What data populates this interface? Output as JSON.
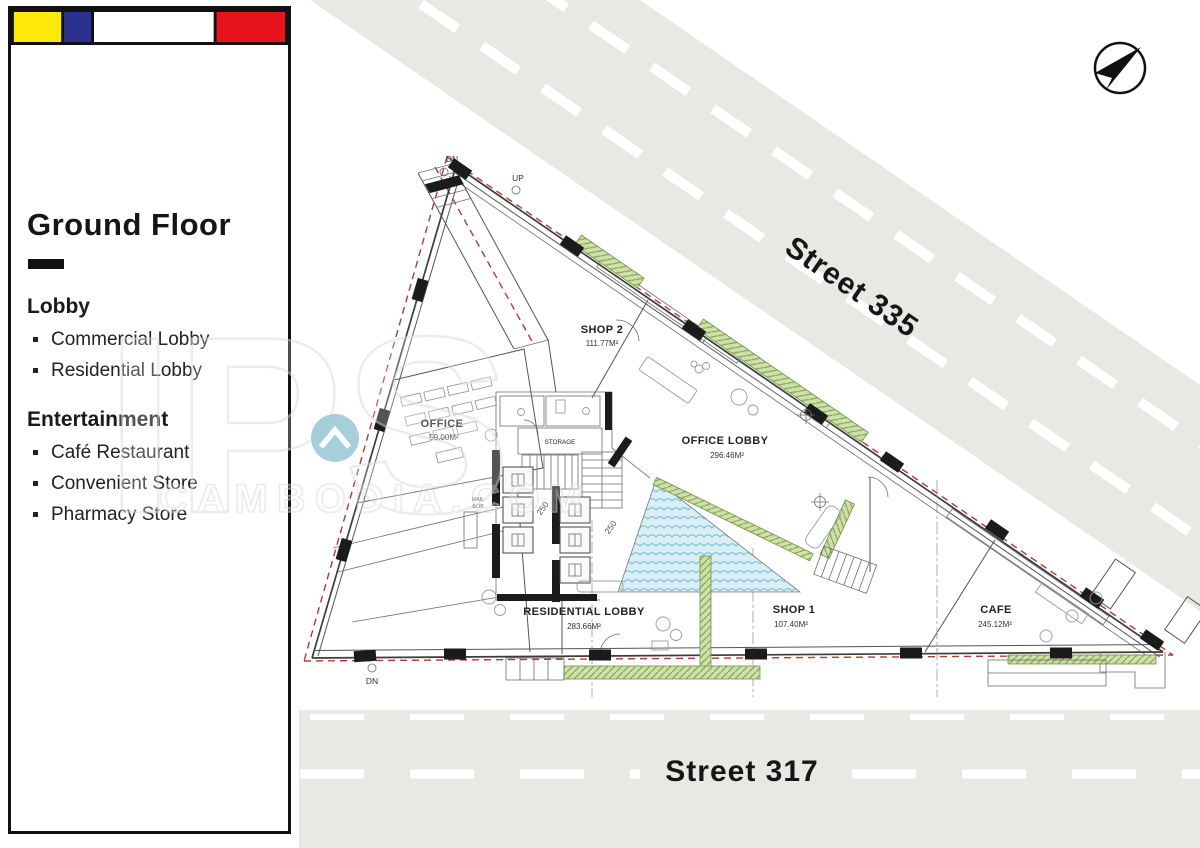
{
  "sidebar": {
    "flag_colors": {
      "frame": "#111111",
      "yellow": "#ffe80a",
      "blue": "#2b2f8e",
      "white": "#ffffff",
      "red": "#e8131d"
    },
    "title": "Ground Floor",
    "sections": [
      {
        "heading": "Lobby",
        "items": [
          "Commercial Lobby",
          "Residential Lobby"
        ]
      },
      {
        "heading": "Entertainment",
        "items": [
          "Café Restaurant",
          "Convenient Store",
          "Pharmacy Store"
        ]
      }
    ]
  },
  "streets": {
    "diagonal_label": "Street 335",
    "bottom_label": "Street 317",
    "asphalt_color": "#e8e8e5"
  },
  "plan": {
    "rooms": [
      {
        "name": "SHOP 2",
        "area": "111.77M²"
      },
      {
        "name": "OFFICE",
        "area": "59.00M²"
      },
      {
        "name": "OFFICE LOBBY",
        "area": "296.46M²"
      },
      {
        "name": "RESIDENTIAL LOBBY",
        "area": "283.66M²"
      },
      {
        "name": "SHOP 1",
        "area": "107.40M²"
      },
      {
        "name": "CAFE",
        "area": "245.12M²"
      }
    ],
    "labels": {
      "storage": "STORAGE",
      "mail_line1": "MAIL",
      "mail_line2": "BOX",
      "dn": "DN",
      "up": "UP",
      "dim_250": "250"
    },
    "colors": {
      "water": "#d9eef5",
      "water_wave": "#74bad2",
      "landscape": "#cfe0a8",
      "landscape_hatch": "#85a85c",
      "boundary_red": "#b23b34"
    }
  },
  "watermark": {
    "line1": "IPS",
    "line2": "CAMBODIA.COM",
    "logo_color": "#4f9fb7"
  },
  "compass": {
    "direction": "NE"
  }
}
